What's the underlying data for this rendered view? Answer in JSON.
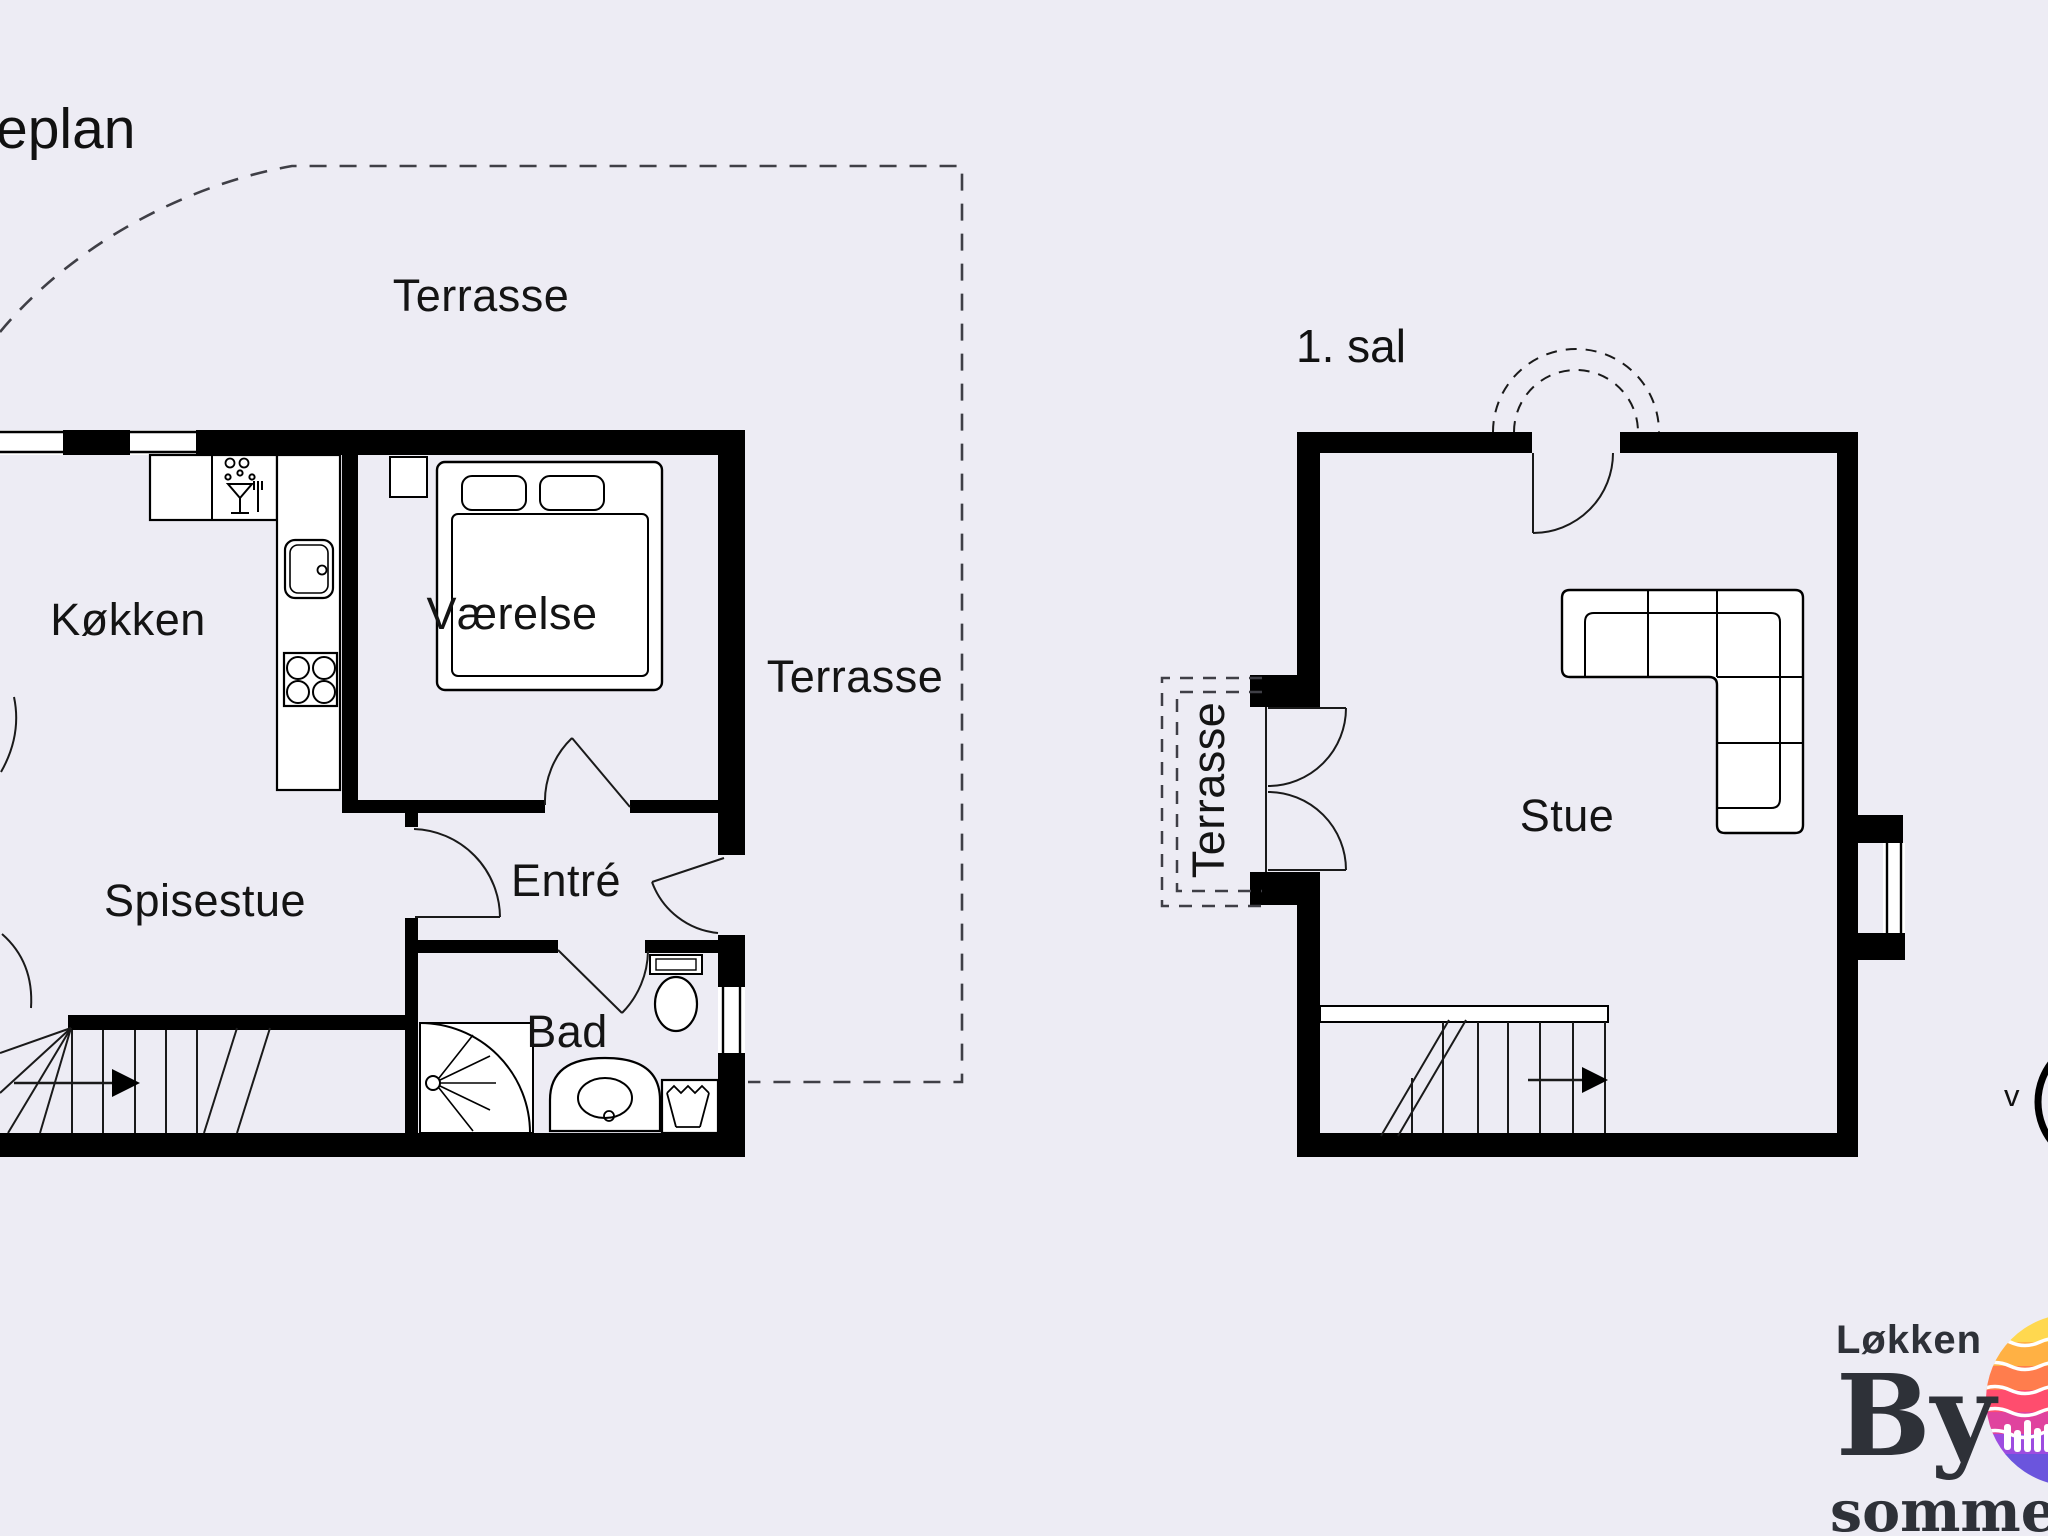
{
  "canvas": {
    "width": 2048,
    "height": 1536,
    "background": "#edecf4",
    "wall_color": "#000000",
    "dash_color": "#3f3f46"
  },
  "ground_floor": {
    "plan_title_partial": "eplan",
    "labels": {
      "terrace_top": "Terrasse",
      "terrace_right": "Terrasse",
      "kitchen": "Køkken",
      "bedroom": "Værelse",
      "dining_room": "Spisestue",
      "entry": "Entré",
      "bathroom": "Bad"
    }
  },
  "first_floor": {
    "title": "1. sal",
    "labels": {
      "living_room": "Stue",
      "terrace": "Terrasse"
    }
  },
  "compass": {
    "west_label": "v"
  },
  "logo": {
    "line1": "Løkken",
    "line2": "By",
    "line3": "sommerh",
    "text_color": "#2e3138",
    "sun_bands": [
      "#ffd84f",
      "#ffb144",
      "#ff7d4d",
      "#ff4d6e",
      "#e0439e",
      "#9d4ce0",
      "#6b55dd"
    ]
  }
}
